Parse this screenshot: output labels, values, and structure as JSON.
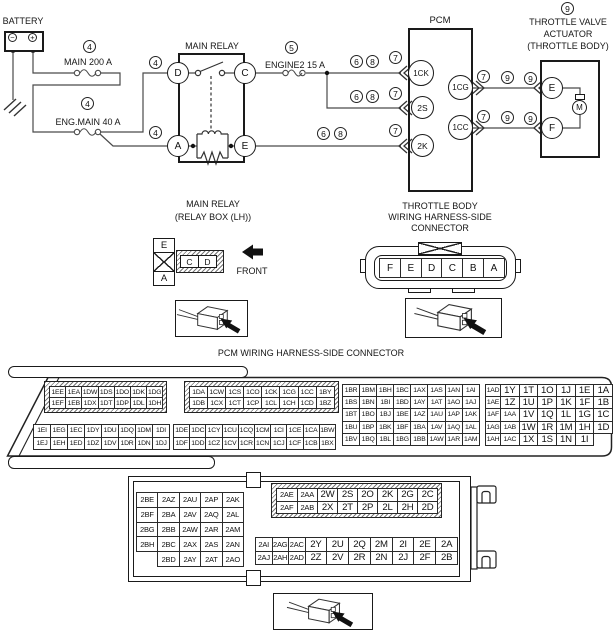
{
  "schematic": {
    "battery_label": "BATTERY",
    "battery_minus": "−",
    "battery_plus": "+",
    "fuse_main_label": "MAIN 200 A",
    "fuse_engmain_label": "ENG.MAIN 40 A",
    "fuse_engine2_label": "ENGINE2 15 A",
    "main_relay_label": "MAIN RELAY",
    "pcm_label": "PCM",
    "actuator_title_1": "THROTTLE VALVE",
    "actuator_title_2": "ACTUATOR",
    "actuator_title_3": "(THROTTLE BODY)",
    "relay_pin_d": "D",
    "relay_pin_c": "C",
    "relay_pin_a": "A",
    "relay_pin_e": "E",
    "pcm_pin_1ck": "1CK",
    "pcm_pin_2s": "2S",
    "pcm_pin_2k": "2K",
    "pcm_pin_1cg": "1CG",
    "pcm_pin_1cc": "1CC",
    "act_pin_e": "E",
    "act_pin_f": "F",
    "motor_label": "M",
    "callouts": {
      "c4": "4",
      "c5": "5",
      "c6": "6",
      "c7": "7",
      "c8": "8",
      "c9": "9"
    }
  },
  "relay_connector": {
    "title1": "MAIN RELAY",
    "title2": "(RELAY BOX (LH))",
    "pin_e": "E",
    "pin_a": "A",
    "pin_c": "C",
    "pin_d": "D",
    "front_label": "FRONT"
  },
  "throttle_connector": {
    "title1": "THROTTLE BODY",
    "title2": "WIRING HARNESS-SIDE",
    "title3": "CONNECTOR",
    "rows": [
      [
        "F",
        "E",
        "D",
        "C",
        "B",
        "A"
      ]
    ]
  },
  "pcm_connector": {
    "title": "PCM WIRING HARNESS-SIDE CONNECTOR",
    "block_a": [
      [
        "1EE",
        "1EA",
        "1DW",
        "1DS",
        "1DO",
        "1DK",
        "1DG"
      ],
      [
        "1EF",
        "1EB",
        "1DX",
        "1DT",
        "1DP",
        "1DL",
        "1DH"
      ]
    ],
    "block_b": [
      [
        "1DA",
        "1CW",
        "1CS",
        "1CO",
        "1CK",
        "1CG",
        "1CC",
        "1BY"
      ],
      [
        "1DB",
        "1CX",
        "1CT",
        "1CP",
        "1CL",
        "1CH",
        "1CD",
        "1BZ"
      ]
    ],
    "block_c": [
      [
        "1BR",
        "1BM",
        "1BH",
        "1BC",
        "1AX",
        "1AS",
        "1AN",
        "1AI"
      ],
      [
        "1BS",
        "1BN",
        "1BI",
        "1BD",
        "1AY",
        "1AT",
        "1AO",
        "1AJ"
      ],
      [
        "1BT",
        "1BO",
        "1BJ",
        "1BE",
        "1AZ",
        "1AU",
        "1AP",
        "1AK"
      ],
      [
        "1BU",
        "1BP",
        "1BK",
        "1BF",
        "1BA",
        "1AV",
        "1AQ",
        "1AL"
      ],
      [
        "1BV",
        "1BQ",
        "1BL",
        "1BG",
        "1BB",
        "1AW",
        "1AR",
        "1AM"
      ]
    ],
    "block_d": [
      [
        "1AD",
        "1Y",
        "1T",
        "1O",
        "1J",
        "1E",
        "1A"
      ],
      [
        "1AE",
        "1Z",
        "1U",
        "1P",
        "1K",
        "1F",
        "1B"
      ],
      [
        "1AF",
        "1AA",
        "1V",
        "1Q",
        "1L",
        "1G",
        "1C"
      ],
      [
        "1AG",
        "1AB",
        "1W",
        "1R",
        "1M",
        "1H",
        "1D"
      ],
      [
        "1AH",
        "1AC",
        "1X",
        "1S",
        "1N",
        "1I"
      ]
    ],
    "block_e": [
      [
        "1EI",
        "1EG",
        "1EC",
        "1DY",
        "1DU",
        "1DQ",
        "1DM",
        "1DI"
      ],
      [
        "1EJ",
        "1EH",
        "1ED",
        "1DZ",
        "1DV",
        "1DR",
        "1DN",
        "1DJ"
      ]
    ],
    "block_f": [
      [
        "1DE",
        "1DC",
        "1CY",
        "1CU",
        "1CQ",
        "1CM",
        "1CI",
        "1CE",
        "1CA",
        "1BW"
      ],
      [
        "1DF",
        "1DD",
        "1CZ",
        "1CV",
        "1CR",
        "1CN",
        "1CJ",
        "1CF",
        "1CB",
        "1BX"
      ]
    ]
  },
  "lower_connector": {
    "block_left": [
      [
        "2BE",
        "2AZ",
        "2AU",
        "2AP",
        "2AK"
      ],
      [
        "2BF",
        "2BA",
        "2AV",
        "2AQ",
        "2AL"
      ],
      [
        "2BG",
        "2BB",
        "2AW",
        "2AR",
        "2AM"
      ],
      [
        "2BH",
        "2BC",
        "2AX",
        "2AS",
        "2AN"
      ],
      [
        null,
        "2BD",
        "2AY",
        "2AT",
        "2AO"
      ]
    ],
    "block_top_right": [
      [
        "2AE",
        "2AA",
        "2W",
        "2S",
        "2O",
        "2K",
        "2G",
        "2C"
      ],
      [
        "2AF",
        "2AB",
        "2X",
        "2T",
        "2P",
        "2L",
        "2H",
        "2D"
      ]
    ],
    "block_bottom_right": [
      [
        "2AI",
        "2AG",
        "2AC",
        "2Y",
        "2U",
        "2Q",
        "2M",
        "2I",
        "2E",
        "2A"
      ],
      [
        "2AJ",
        "2AH",
        "2AD",
        "2Z",
        "2V",
        "2R",
        "2N",
        "2J",
        "2F",
        "2B"
      ]
    ]
  }
}
